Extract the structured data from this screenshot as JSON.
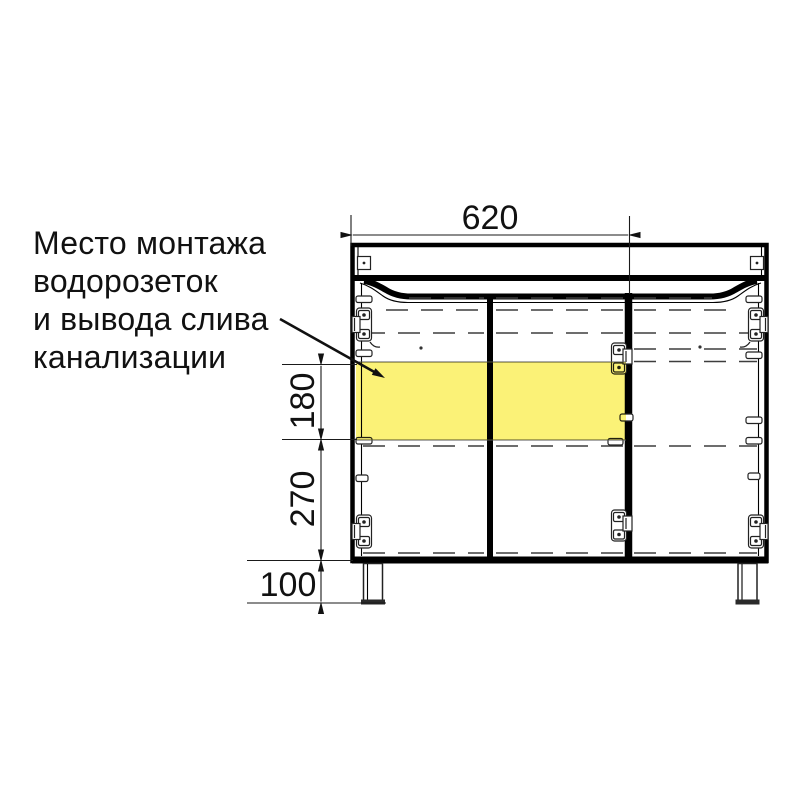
{
  "annotation": {
    "lines": [
      "Место монтажа",
      "водорозеток",
      "и вывода слива",
      "канализации"
    ]
  },
  "dimensions": {
    "top_width_mm": "620",
    "outlet_zone_height_mm": "180",
    "zone_bottom_offset_mm": "270",
    "leg_height_mm": "100"
  },
  "colors": {
    "highlight": "#fbf277",
    "line": "#000000",
    "background": "#ffffff"
  }
}
